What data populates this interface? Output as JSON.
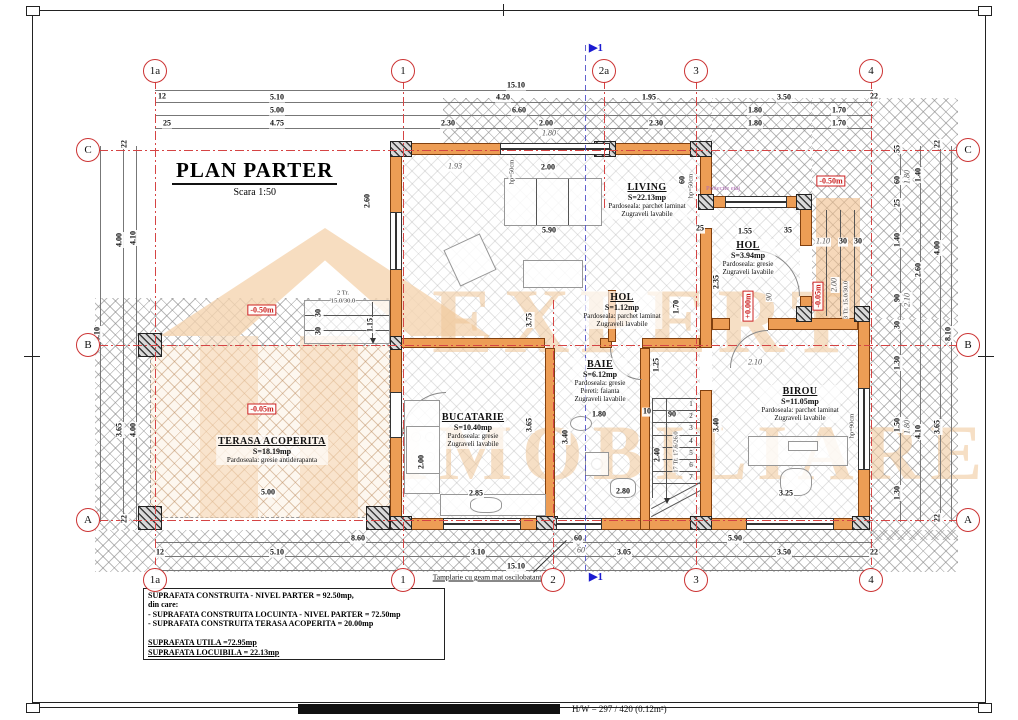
{
  "title": {
    "main": "PLAN PARTER",
    "scale": "Scara 1:50"
  },
  "sheet": {
    "footer": "H/W = 297 / 420 (0.12m²)"
  },
  "watermark": {
    "line1": "EXPERT",
    "line2": "IMOBILIARE"
  },
  "annotations": {
    "tamplarie": "Tamplarie cu geam mat oscilobatant",
    "proiectie": "Proiectie etaj",
    "section_label": "▶1"
  },
  "summary": [
    {
      "t": "SUPRAFATA CONSTRUITA - NIVEL PARTER = 92.50mp,",
      "u": 0
    },
    {
      "t": "din care:",
      "u": 0
    },
    {
      "t": " - SUPRAFATA CONSTRUITA LOCUINTA - NIVEL PARTER = 72.50mp",
      "u": 0
    },
    {
      "t": " - SUPRAFATA CONSTRUITA TERASA ACOPERITA = 20.00mp",
      "u": 0
    },
    {
      "t": " ",
      "u": 0
    },
    {
      "t": "SUPRAFATA UTILA =72.95mp",
      "u": 1
    },
    {
      "t": "SUPRAFATA LOCUIBILA = 22.13mp",
      "u": 1
    }
  ],
  "grid": {
    "top": [
      {
        "t": "1a",
        "x": 155
      },
      {
        "t": "1",
        "x": 403
      },
      {
        "t": "2a",
        "x": 604
      },
      {
        "t": "3",
        "x": 696
      },
      {
        "t": "4",
        "x": 871
      }
    ],
    "bottom": [
      {
        "t": "1a",
        "x": 155
      },
      {
        "t": "1",
        "x": 403
      },
      {
        "t": "2",
        "x": 553
      },
      {
        "t": "3",
        "x": 696
      },
      {
        "t": "4",
        "x": 871
      }
    ],
    "left": [
      {
        "t": "C",
        "y": 150
      },
      {
        "t": "B",
        "y": 345
      },
      {
        "t": "A",
        "y": 520
      }
    ],
    "right": [
      {
        "t": "C",
        "y": 150
      },
      {
        "t": "B",
        "y": 345
      },
      {
        "t": "A",
        "y": 520
      }
    ]
  },
  "rooms": [
    {
      "name": "LIVING",
      "area": "S=22.13mp",
      "lines": [
        "Pardoseala: parchet laminat",
        "Zugraveli lavabile"
      ],
      "x": 647,
      "y": 200
    },
    {
      "name": "HOL",
      "area": "S=3.94mp",
      "lines": [
        "Pardoseala: gresie",
        "Zugraveli lavabile"
      ],
      "x": 748,
      "y": 258
    },
    {
      "name": "HOL",
      "area": "S=1.12mp",
      "lines": [
        "Pardoseala: parchet laminat",
        "Zugraveli lavabile"
      ],
      "x": 622,
      "y": 310
    },
    {
      "name": "BAIE",
      "area": "S=6.12mp",
      "lines": [
        "Pardoseala: gresie",
        "Pereti: faianta",
        "Zugraveli lavabile"
      ],
      "x": 600,
      "y": 381
    },
    {
      "name": "BUCATARIE",
      "area": "S=10.40mp",
      "lines": [
        "Pardoseala: gresie",
        "Zugraveli lavabile"
      ],
      "x": 473,
      "y": 430
    },
    {
      "name": "BIROU",
      "area": "S=11.05mp",
      "lines": [
        "Pardoseala: parchet laminat",
        "Zugraveli lavabile"
      ],
      "x": 800,
      "y": 404
    },
    {
      "name": "TERASA ACOPERITA",
      "area": "S=18.19mp",
      "lines": [
        "Pardoseala: gresie antiderapanta"
      ],
      "x": 272,
      "y": 450
    }
  ],
  "levels": [
    {
      "t": "-0.50m",
      "x": 262,
      "y": 310,
      "r": 0
    },
    {
      "t": "-0.05m",
      "x": 262,
      "y": 409,
      "r": 0
    },
    {
      "t": "-0.50m",
      "x": 831,
      "y": 181,
      "r": 0
    },
    {
      "t": "+0.00m",
      "x": 748,
      "y": 306,
      "r": 1
    },
    {
      "t": "-0.05m",
      "x": 818,
      "y": 296,
      "r": 1
    }
  ],
  "stairs": {
    "numbers": [
      "1",
      "2",
      "3",
      "4",
      "5",
      "6",
      "7"
    ]
  },
  "misc": [
    {
      "t": "2 Tr.",
      "x": 343,
      "y": 293,
      "r": 0
    },
    {
      "t": "15.0/30.0",
      "x": 343,
      "y": 301,
      "r": 0
    },
    {
      "t": "3 Tr. 15.0/30.0",
      "x": 846,
      "y": 300,
      "r": 1
    },
    {
      "t": "17 Tr. 17.6/26.0",
      "x": 676,
      "y": 452,
      "r": 1
    },
    {
      "t": "hp=50cm",
      "x": 512,
      "y": 172,
      "r": 1
    },
    {
      "t": "hp=50cm",
      "x": 691,
      "y": 186,
      "r": 1
    },
    {
      "t": "hp=90cm",
      "x": 852,
      "y": 426,
      "r": 1
    }
  ],
  "dims": [
    {
      "t": "15.10",
      "x": 516,
      "y": 86
    },
    {
      "t": "12",
      "x": 162,
      "y": 97
    },
    {
      "t": "5.10",
      "x": 277,
      "y": 98
    },
    {
      "t": "4.20",
      "x": 503,
      "y": 98
    },
    {
      "t": "1.95",
      "x": 649,
      "y": 98
    },
    {
      "t": "3.50",
      "x": 784,
      "y": 98
    },
    {
      "t": "22",
      "x": 874,
      "y": 97
    },
    {
      "t": "5.00",
      "x": 277,
      "y": 111
    },
    {
      "t": "6.60",
      "x": 519,
      "y": 111
    },
    {
      "t": "1.80",
      "x": 755,
      "y": 111
    },
    {
      "t": "1.70",
      "x": 839,
      "y": 111
    },
    {
      "t": "25",
      "x": 167,
      "y": 124
    },
    {
      "t": "4.75",
      "x": 277,
      "y": 124
    },
    {
      "t": "2.30",
      "x": 448,
      "y": 124
    },
    {
      "t": "2.00",
      "x": 546,
      "y": 124
    },
    {
      "t": "2.30",
      "x": 656,
      "y": 124
    },
    {
      "t": "1.80",
      "x": 755,
      "y": 124
    },
    {
      "t": "1.70",
      "x": 839,
      "y": 124
    },
    {
      "t": "1.80",
      "x": 549,
      "y": 134,
      "i": 1
    },
    {
      "t": "8.60",
      "x": 358,
      "y": 539
    },
    {
      "t": "60",
      "x": 578,
      "y": 539
    },
    {
      "t": "5.90",
      "x": 735,
      "y": 539
    },
    {
      "t": "12",
      "x": 160,
      "y": 553
    },
    {
      "t": "5.10",
      "x": 277,
      "y": 553
    },
    {
      "t": "3.10",
      "x": 478,
      "y": 553
    },
    {
      "t": "60",
      "x": 581,
      "y": 551,
      "i": 1
    },
    {
      "t": "3.05",
      "x": 624,
      "y": 553
    },
    {
      "t": "3.50",
      "x": 784,
      "y": 553
    },
    {
      "t": "22",
      "x": 874,
      "y": 553
    },
    {
      "t": "15.10",
      "x": 516,
      "y": 567
    },
    {
      "t": "22",
      "x": 125,
      "y": 144,
      "r": 1
    },
    {
      "t": "4.00",
      "x": 120,
      "y": 240,
      "r": 1
    },
    {
      "t": "4.10",
      "x": 134,
      "y": 238,
      "r": 1
    },
    {
      "t": "8.10",
      "x": 98,
      "y": 334,
      "r": 1
    },
    {
      "t": "3.65",
      "x": 120,
      "y": 430,
      "r": 1
    },
    {
      "t": "4.00",
      "x": 134,
      "y": 430,
      "r": 1
    },
    {
      "t": "22",
      "x": 125,
      "y": 519,
      "r": 1
    },
    {
      "t": "22",
      "x": 938,
      "y": 144,
      "r": 1
    },
    {
      "t": "55",
      "x": 898,
      "y": 149,
      "r": 1
    },
    {
      "t": "60",
      "x": 898,
      "y": 180,
      "r": 1
    },
    {
      "t": "1.80",
      "x": 908,
      "y": 177,
      "r": 1,
      "i": 1
    },
    {
      "t": "1.40",
      "x": 919,
      "y": 175,
      "r": 1
    },
    {
      "t": "25",
      "x": 898,
      "y": 203,
      "r": 1
    },
    {
      "t": "1.40",
      "x": 898,
      "y": 240,
      "r": 1
    },
    {
      "t": "4.00",
      "x": 938,
      "y": 248,
      "r": 1
    },
    {
      "t": "2.60",
      "x": 919,
      "y": 270,
      "r": 1
    },
    {
      "t": "90",
      "x": 898,
      "y": 298,
      "r": 1
    },
    {
      "t": "2.10",
      "x": 908,
      "y": 300,
      "r": 1,
      "i": 1
    },
    {
      "t": "30",
      "x": 898,
      "y": 325,
      "r": 1
    },
    {
      "t": "8.10",
      "x": 949,
      "y": 334,
      "r": 1
    },
    {
      "t": "1.30",
      "x": 898,
      "y": 363,
      "r": 1
    },
    {
      "t": "1.50",
      "x": 898,
      "y": 425,
      "r": 1
    },
    {
      "t": "1.80",
      "x": 908,
      "y": 427,
      "r": 1,
      "i": 1
    },
    {
      "t": "4.10",
      "x": 919,
      "y": 432,
      "r": 1
    },
    {
      "t": "3.65",
      "x": 938,
      "y": 427,
      "r": 1
    },
    {
      "t": "1.30",
      "x": 898,
      "y": 493,
      "r": 1
    },
    {
      "t": "22",
      "x": 938,
      "y": 518,
      "r": 1
    },
    {
      "t": "1.93",
      "x": 455,
      "y": 167,
      "i": 1
    },
    {
      "t": "2.00",
      "x": 548,
      "y": 168
    },
    {
      "t": "5.90",
      "x": 549,
      "y": 231
    },
    {
      "t": "3.75",
      "x": 530,
      "y": 320,
      "r": 1
    },
    {
      "t": "60",
      "x": 683,
      "y": 180,
      "r": 1
    },
    {
      "t": "2.60",
      "x": 368,
      "y": 201,
      "r": 1
    },
    {
      "t": "1.15",
      "x": 371,
      "y": 325,
      "r": 1
    },
    {
      "t": "30",
      "x": 319,
      "y": 313,
      "r": 1
    },
    {
      "t": "30",
      "x": 319,
      "y": 331,
      "r": 1
    },
    {
      "t": "2.00",
      "x": 422,
      "y": 462,
      "r": 1
    },
    {
      "t": "3.65",
      "x": 530,
      "y": 425,
      "r": 1
    },
    {
      "t": "2.85",
      "x": 476,
      "y": 494
    },
    {
      "t": "3.40",
      "x": 566,
      "y": 437,
      "r": 1
    },
    {
      "t": "1.80",
      "x": 599,
      "y": 415
    },
    {
      "t": "10",
      "x": 647,
      "y": 412
    },
    {
      "t": "90",
      "x": 672,
      "y": 415
    },
    {
      "t": "2.40",
      "x": 658,
      "y": 455,
      "r": 1
    },
    {
      "t": "3.40",
      "x": 717,
      "y": 425,
      "r": 1
    },
    {
      "t": "2.80",
      "x": 623,
      "y": 492
    },
    {
      "t": "1.25",
      "x": 657,
      "y": 365,
      "r": 1
    },
    {
      "t": "1.70",
      "x": 677,
      "y": 307,
      "r": 1
    },
    {
      "t": "25",
      "x": 700,
      "y": 229
    },
    {
      "t": "1.55",
      "x": 745,
      "y": 232
    },
    {
      "t": "35",
      "x": 788,
      "y": 231
    },
    {
      "t": "2.35",
      "x": 717,
      "y": 282,
      "r": 1
    },
    {
      "t": "1.10",
      "x": 823,
      "y": 242,
      "i": 1
    },
    {
      "t": "30",
      "x": 843,
      "y": 242
    },
    {
      "t": "30",
      "x": 858,
      "y": 242
    },
    {
      "t": "2.00",
      "x": 835,
      "y": 285,
      "r": 1,
      "i": 1
    },
    {
      "t": "90",
      "x": 770,
      "y": 297,
      "r": 1,
      "i": 1
    },
    {
      "t": "3.25",
      "x": 786,
      "y": 494
    },
    {
      "t": "2.10",
      "x": 755,
      "y": 363,
      "i": 1
    },
    {
      "t": "5.00",
      "x": 268,
      "y": 493
    }
  ]
}
